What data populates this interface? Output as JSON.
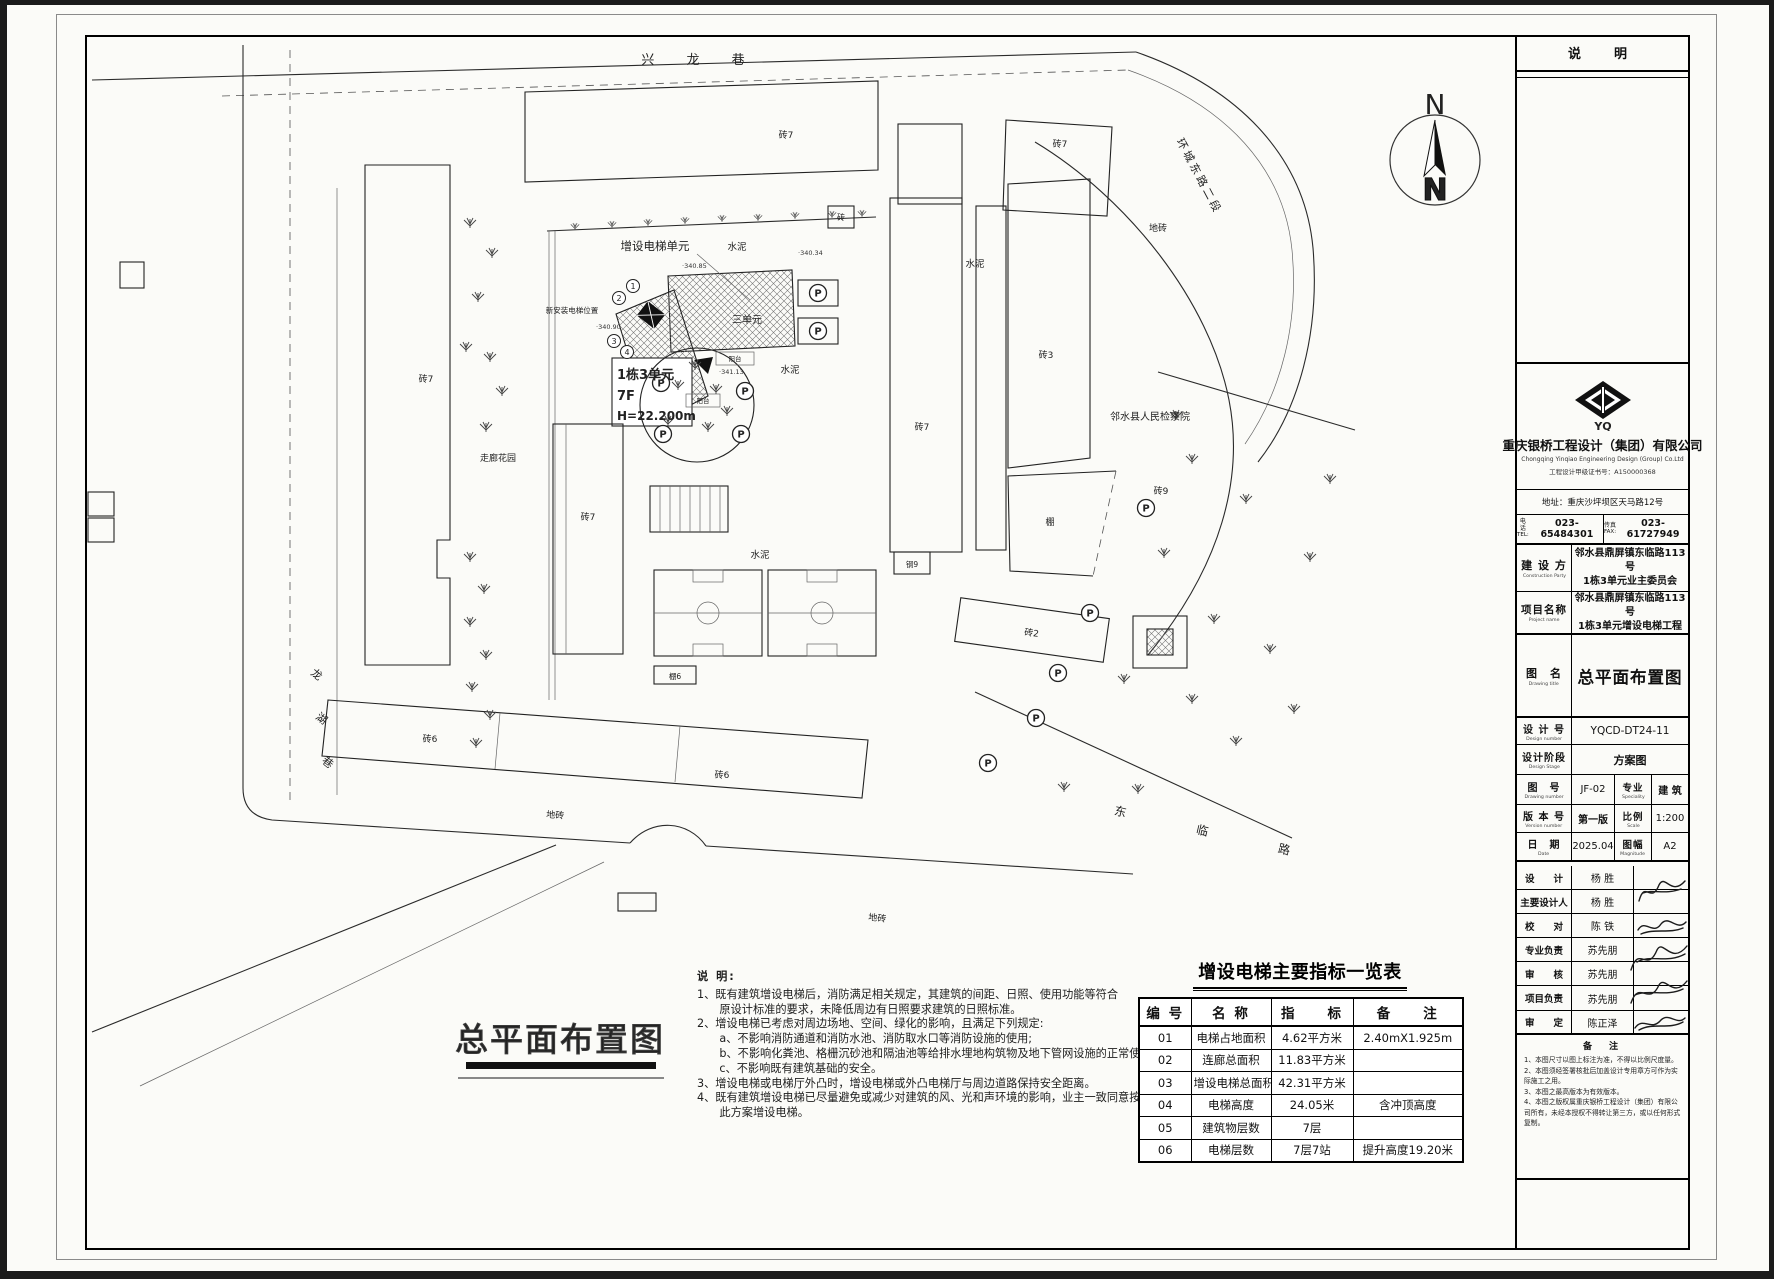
{
  "sheet": {
    "note_panel_header": "说　明",
    "big_title": "总平面布置图"
  },
  "company": {
    "logo_text": "YQ",
    "name_cn": "重庆银桥工程设计（集团）有限公司",
    "name_en": "Chongqing Yinqiao Engineering Design (Group) Co.Ltd",
    "cert": "工程设计甲级证书号：A150000368",
    "address": "地址：重庆沙坪坝区天马路12号",
    "tel_zh": "电话",
    "tel_en": "TEL:",
    "tel": "023-65484301",
    "fax_zh": "传真",
    "fax_en": "FAX:",
    "fax": "023-61727949"
  },
  "title_block": {
    "construction_zh": "建 设 方",
    "construction_en": "Construction Party",
    "construction_value1": "邻水县鼎屏镇东临路113号",
    "construction_value2": "1栋3单元业主委员会",
    "project_zh": "项目名称",
    "project_en": "Project name",
    "project_value1": "邻水县鼎屏镇东临路113号",
    "project_value2": "1栋3单元增设电梯工程",
    "drawing_zh": "图　名",
    "drawing_en": "Drawing title",
    "drawing_value": "总平面布置图",
    "design_no_zh": "设 计 号",
    "design_no_en": "Design number",
    "design_no_value": "YQCD-DT24-11",
    "stage_zh": "设计阶段",
    "stage_en": "Design Stage",
    "stage_value": "方案图",
    "drawing_no_zh": "图　号",
    "drawing_no_en": "Drawing number",
    "drawing_no_value": "JF-02",
    "speciality_zh": "专业",
    "speciality_en": "Speciality",
    "speciality_value": "建 筑",
    "version_zh": "版 本 号",
    "version_en": "Version number",
    "version_value": "第一版",
    "scale_zh": "比例",
    "scale_en": "Scale",
    "scale_value": "1:200",
    "date_zh": "日　期",
    "date_en": "Date",
    "date_value": "2025.04",
    "format_zh": "图幅",
    "format_en": "Magnitude",
    "format_value": "A2"
  },
  "signatures": [
    {
      "role": "设　　计",
      "name": "杨 胜"
    },
    {
      "role": "主要设计人",
      "name": "杨 胜"
    },
    {
      "role": "校　　对",
      "name": "陈 铁"
    },
    {
      "role": "专业负责",
      "name": "苏先朋"
    },
    {
      "role": "审　　核",
      "name": "苏先朋"
    },
    {
      "role": "项目负责",
      "name": "苏先朋"
    },
    {
      "role": "审　　定",
      "name": "陈正泽"
    }
  ],
  "remarks": {
    "header": "备　注",
    "lines": [
      "1、本图尺寸以图上标注为准，不得以比例尺度量。",
      "2、本图须经签署核批后加盖设计专用章方可作为实际施工之用。",
      "3、本图之最高版本为有效版本。",
      "4、本图之版权属重庆银桥工程设计（集团）有限公司所有，未经本授权不得转让第三方，或以任何形式复制。"
    ]
  },
  "notes": {
    "header": "说 明:",
    "lines": [
      "1、既有建筑增设电梯后，消防满足相关规定，其建筑的间距、日照、使用功能等符合",
      "　　原设计标准的要求，未降低周边有日照要求建筑的日照标准。",
      "2、增设电梯已考虑对周边场地、空间、绿化的影响，且满足下列规定:",
      "　　a、不影响消防通道和消防水池、消防取水口等消防设施的使用;",
      "　　b、不影响化粪池、格栅沉砂池和隔油池等给排水埋地构筑物及地下管网设施的正常使用;",
      "　　c、不影响既有建筑基础的安全。",
      "3、增设电梯或电梯厅外凸时，增设电梯或外凸电梯厅与周边道路保持安全距离。",
      "4、既有建筑增设电梯已尽量避免或减少对建筑的风、光和声环境的影响，业主一致同意按照",
      "　　此方案增设电梯。"
    ]
  },
  "table": {
    "title": "增设电梯主要指标一览表",
    "headers": [
      "编 号",
      "名 称",
      "指　　标",
      "备　　注"
    ],
    "rows": [
      [
        "01",
        "电梯占地面积",
        "4.62平方米",
        "2.40mX1.925m"
      ],
      [
        "02",
        "连廊总面积",
        "11.83平方米",
        ""
      ],
      [
        "03",
        "增设电梯总面积",
        "42.31平方米",
        ""
      ],
      [
        "04",
        "电梯高度",
        "24.05米",
        "含冲顶高度"
      ],
      [
        "05",
        "建筑物层数",
        "7层",
        ""
      ],
      [
        "06",
        "电梯层数",
        "7层7站",
        "提升高度19.20米"
      ]
    ]
  },
  "plan": {
    "compass_n": "N",
    "circled": [
      "1",
      "2",
      "3",
      "4"
    ],
    "labels": {
      "xinglong_lane": "兴 龙 巷",
      "huancheng_road": "环城东路二段",
      "donglin_road": "东　临　路",
      "longhu_1": "龙",
      "longhu_2": "湖",
      "longhu_3": "巷",
      "add_elevator_unit": "增设电梯单元",
      "new_elevator_pos": "新安装电梯位置",
      "unit3": "三单元",
      "bldg_line1": "1栋3单元",
      "bldg_line2": "7F",
      "bldg_line3": "H=22.200m",
      "cement": "水泥",
      "brick7": "砖7",
      "brick3": "砖3",
      "brick9": "砖9",
      "brick2": "砖2",
      "brick6": "砖6",
      "brick": "砖",
      "steel9": "钢9",
      "shed": "棚",
      "shed6": "棚6",
      "floor_tile": "地砖",
      "balcony": "阳台",
      "prosecutor": "邻水县人民检察院",
      "corridor_garden": "走廊花园",
      "parking": "P",
      "elev_340_85": "·340.85",
      "elev_340_90": "·340.90",
      "elev_341_13": "·341.13",
      "elev_340_34": "·340.34"
    }
  }
}
